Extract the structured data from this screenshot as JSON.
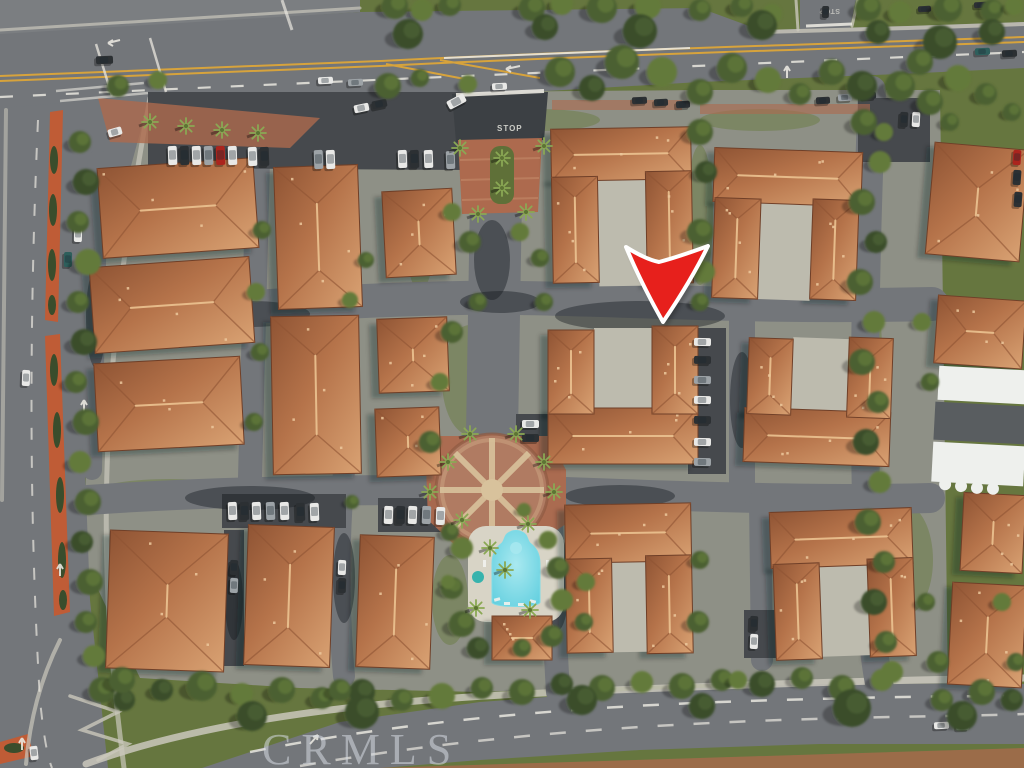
{
  "scene": {
    "type": "aerial-photo",
    "description": "Aerial drone view of a Spanish-style condominium community with terracotta tile roofs, interior streets, parking courts, a central circular brick plaza, a swimming pool, bordered by a boulevard on top, a median-divided street on the left and a curving road at the bottom",
    "watermark": "CRMLS",
    "road_marking_stop": "STOP"
  },
  "marker": {
    "shape": "downward-arrow",
    "fill": "#e7201c",
    "outline": "#ffffff"
  },
  "colors": {
    "veg": "#66763f",
    "veg2": "#6d7e48",
    "ground": "#8e9086",
    "road": "#73767a",
    "roadLight": "#7b7e81",
    "lot": "#46494d",
    "sidewalk": "#cac8bc",
    "concrete": "#bdbbae",
    "brick": "#ad6a4e",
    "brickLight": "#c8906e",
    "plazaBase": "#b07b62",
    "plazaSpoke": "#d8c29c",
    "grass": "#7b8f4d",
    "treeDark": "#3a4d2c",
    "treeMid": "#4c6133",
    "treeLight": "#647a3a",
    "palm": "#8aa854",
    "roofLight": "#d9a273",
    "roofMid": "#b5734a",
    "roofDark": "#8f5434",
    "roofEdge": "#6f3f28",
    "ridge": "#ecc391",
    "pool": "#62cfdf",
    "poolLight": "#a9e9f0",
    "deck": "#d8d4c6",
    "yellow": "#d7a33c",
    "lineWhite": "#e9e7df",
    "medianOrange": "#bf5c36",
    "carRed": "#ab241d",
    "arrowRed": "#e7201c",
    "watermark": "#d6dbe2"
  }
}
